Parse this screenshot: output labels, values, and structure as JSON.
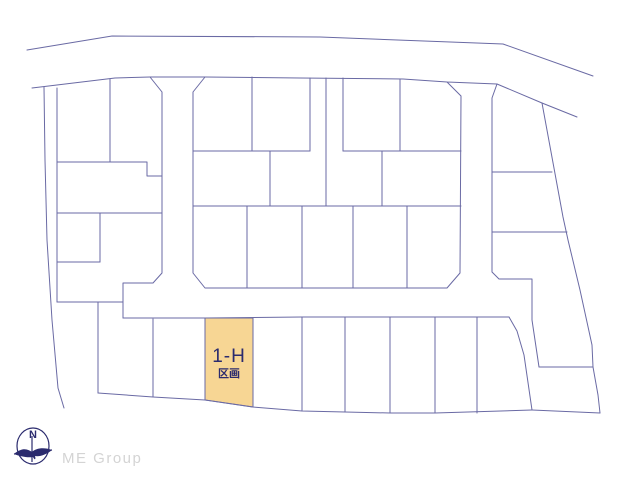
{
  "page": {
    "background": "#ffffff",
    "width": 640,
    "height": 480
  },
  "colors": {
    "line": "#6a6aa4",
    "highlight_fill": "#f7d694",
    "label": "#2b2b6e",
    "compass": "#2b2b6e",
    "brand": "#d4d4d4"
  },
  "map": {
    "kind": "subdivision-lot-plan",
    "highlight": {
      "label": "1-H",
      "sublabel": "区画",
      "fill": "#f7d694",
      "polygon": [
        [
          205,
          318
        ],
        [
          253,
          318
        ],
        [
          253,
          407
        ],
        [
          205,
          400
        ]
      ],
      "label_x": 229,
      "label_y": 362,
      "sublabel_x": 229,
      "sublabel_y": 377
    },
    "paths": [
      [
        [
          27,
          50
        ],
        [
          112,
          36
        ],
        [
          320,
          37
        ],
        [
          503,
          44
        ],
        [
          593,
          76
        ]
      ],
      [
        [
          32,
          88
        ],
        [
          115,
          78
        ],
        [
          150,
          77
        ],
        [
          205,
          77
        ],
        [
          300,
          78
        ],
        [
          403,
          79
        ],
        [
          447,
          82
        ],
        [
          497,
          84
        ],
        [
          542,
          103
        ],
        [
          577,
          117
        ]
      ],
      [
        [
          150,
          77
        ],
        [
          162,
          92
        ],
        [
          162,
          273
        ],
        [
          153,
          283
        ],
        [
          123,
          283
        ],
        [
          123,
          318
        ]
      ],
      [
        [
          205,
          77
        ],
        [
          193,
          92
        ],
        [
          193,
          273
        ],
        [
          205,
          288
        ],
        [
          447,
          288
        ],
        [
          460,
          273
        ],
        [
          461,
          96
        ],
        [
          447,
          82
        ]
      ],
      [
        [
          497,
          84
        ],
        [
          492,
          98
        ],
        [
          492,
          272
        ],
        [
          499,
          279
        ],
        [
          532,
          279
        ],
        [
          532,
          320
        ],
        [
          539,
          367
        ],
        [
          593,
          367
        ]
      ],
      [
        [
          542,
          103
        ],
        [
          563,
          217
        ],
        [
          568,
          240
        ],
        [
          580,
          290
        ],
        [
          592,
          345
        ],
        [
          593,
          367
        ],
        [
          598,
          395
        ],
        [
          600,
          413
        ]
      ],
      [
        [
          532,
          410
        ],
        [
          600,
          413
        ]
      ],
      [
        [
          509,
          317
        ],
        [
          517,
          331
        ],
        [
          524,
          355
        ],
        [
          532,
          410
        ]
      ],
      [
        [
          492,
          172
        ],
        [
          552,
          172
        ]
      ],
      [
        [
          492,
          232
        ],
        [
          567,
          232
        ]
      ],
      [
        [
          123,
          318
        ],
        [
          205,
          318
        ],
        [
          302,
          317
        ],
        [
          400,
          317
        ],
        [
          509,
          317
        ]
      ],
      [
        [
          44,
          87
        ],
        [
          45,
          160
        ],
        [
          47,
          240
        ],
        [
          52,
          320
        ],
        [
          58,
          388
        ],
        [
          64,
          408
        ]
      ],
      [
        [
          57,
          88
        ],
        [
          57,
          302
        ]
      ],
      [
        [
          57,
          162
        ],
        [
          147,
          162
        ],
        [
          147,
          176
        ],
        [
          162,
          176
        ]
      ],
      [
        [
          110,
          79
        ],
        [
          110,
          162
        ]
      ],
      [
        [
          57,
          213
        ],
        [
          162,
          213
        ]
      ],
      [
        [
          100,
          213
        ],
        [
          100,
          262
        ]
      ],
      [
        [
          57,
          262
        ],
        [
          100,
          262
        ]
      ],
      [
        [
          57,
          302
        ],
        [
          123,
          302
        ]
      ],
      [
        [
          98,
          302
        ],
        [
          98,
          393
        ]
      ],
      [
        [
          98,
          393
        ],
        [
          153,
          397
        ],
        [
          205,
          400
        ],
        [
          253,
          407
        ],
        [
          302,
          411
        ],
        [
          345,
          412
        ],
        [
          390,
          413
        ],
        [
          435,
          413
        ],
        [
          532,
          410
        ]
      ],
      [
        [
          153,
          319
        ],
        [
          153,
          397
        ]
      ],
      [
        [
          205,
          318
        ],
        [
          205,
          400
        ]
      ],
      [
        [
          253,
          318
        ],
        [
          253,
          407
        ]
      ],
      [
        [
          302,
          317
        ],
        [
          302,
          411
        ]
      ],
      [
        [
          345,
          317
        ],
        [
          345,
          412
        ]
      ],
      [
        [
          390,
          317
        ],
        [
          390,
          413
        ]
      ],
      [
        [
          435,
          317
        ],
        [
          435,
          413
        ]
      ],
      [
        [
          477,
          317
        ],
        [
          477,
          413
        ]
      ],
      [
        [
          193,
          151
        ],
        [
          310,
          151
        ]
      ],
      [
        [
          343,
          151
        ],
        [
          461,
          151
        ]
      ],
      [
        [
          252,
          77
        ],
        [
          252,
          151
        ]
      ],
      [
        [
          310,
          78
        ],
        [
          310,
          151
        ]
      ],
      [
        [
          326,
          78
        ],
        [
          326,
          206
        ]
      ],
      [
        [
          343,
          78
        ],
        [
          343,
          151
        ]
      ],
      [
        [
          400,
          79
        ],
        [
          400,
          151
        ]
      ],
      [
        [
          193,
          206
        ],
        [
          461,
          206
        ]
      ],
      [
        [
          270,
          151
        ],
        [
          270,
          206
        ]
      ],
      [
        [
          382,
          151
        ],
        [
          382,
          206
        ]
      ],
      [
        [
          247,
          206
        ],
        [
          247,
          288
        ]
      ],
      [
        [
          302,
          206
        ],
        [
          302,
          288
        ]
      ],
      [
        [
          353,
          206
        ],
        [
          353,
          288
        ]
      ],
      [
        [
          407,
          206
        ],
        [
          407,
          288
        ]
      ]
    ]
  },
  "compass": {
    "north_label": "N"
  },
  "footer": {
    "brand": "ME Group"
  }
}
